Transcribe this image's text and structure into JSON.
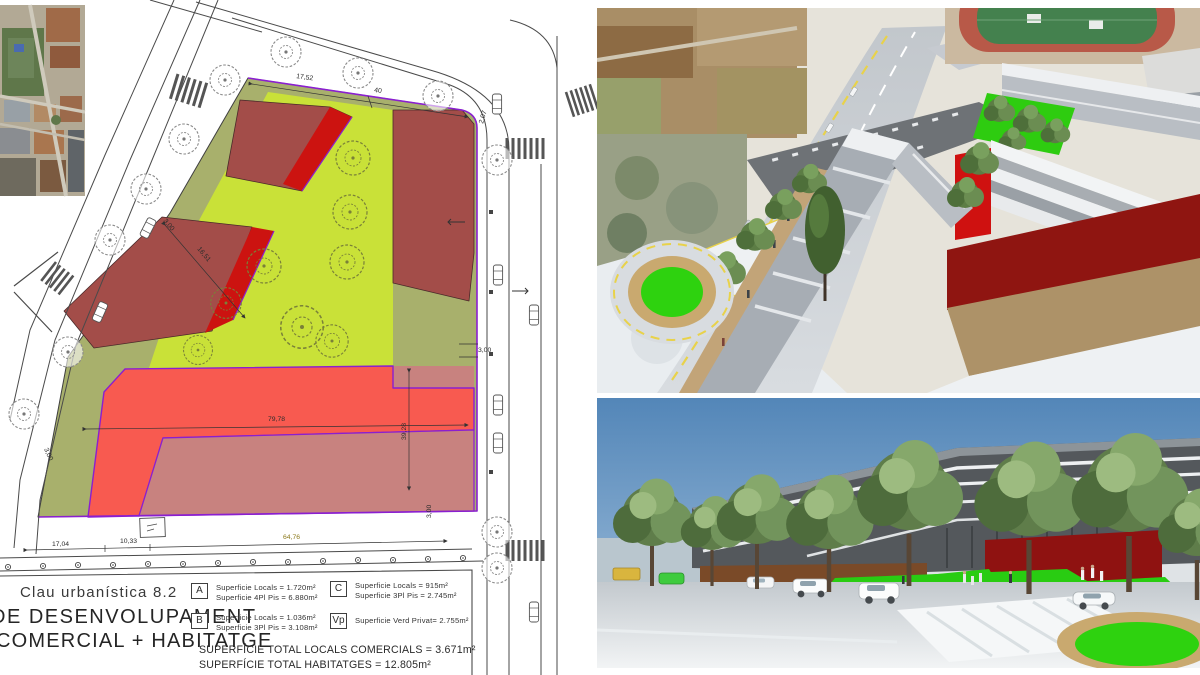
{
  "plan": {
    "title": "Clau urbanística 8.2",
    "dev_line1": "DE  DESENVOLUPAMENT",
    "dev_line2": "COMERCIAL + HABITATGE",
    "legend": {
      "a_key": "A",
      "a_line1": "Superficie Locals = 1.720m²",
      "a_line2": "Superficie 4Pl Pis = 6.880m²",
      "b_key": "B",
      "b_line1": "Superficie Locals = 1.036m²",
      "b_line2": "Superficie 3Pl Pis = 3.108m²",
      "c_key": "C",
      "c_line1": "Superficie Locals = 915m²",
      "c_line2": "Superficie 3Pl Pis = 2.745m²",
      "vp_key": "Vp",
      "vp_line1": "Superficie Verd Privat= 2.755m²"
    },
    "totals_line1": "SUPERFÍCIE TOTAL LOCALS COMERCIALS = 3.671m²",
    "totals_line2": "SUPERFÍCIE TOTAL HABITATGES = 12.805m²",
    "dims": {
      "top_a": "17,52",
      "top_b": "40",
      "corner": "2,07",
      "left_a": "3,00",
      "diag": "16,51",
      "mid": "79,78",
      "right_v": "39,28",
      "right_s": "3,00",
      "left_b": "3,00",
      "bottom_a": "17,04",
      "bottom_b": "10,33",
      "bottom_c": "64,76",
      "bottom_r": "3,00"
    },
    "zone_colors": {
      "private_green": "#a8b06c",
      "garden": "#c9e138",
      "building_dark_red": "#a34d49",
      "building_bright_red": "#cc1310",
      "zone_b_red": "#f85a50",
      "zone_mauve": "#c8827f",
      "boundary_purple": "#8a1fd0"
    }
  },
  "renders": {
    "top": {
      "name": "aerial-3d-massing-view"
    },
    "bottom": {
      "name": "street-level-3d-view"
    }
  }
}
